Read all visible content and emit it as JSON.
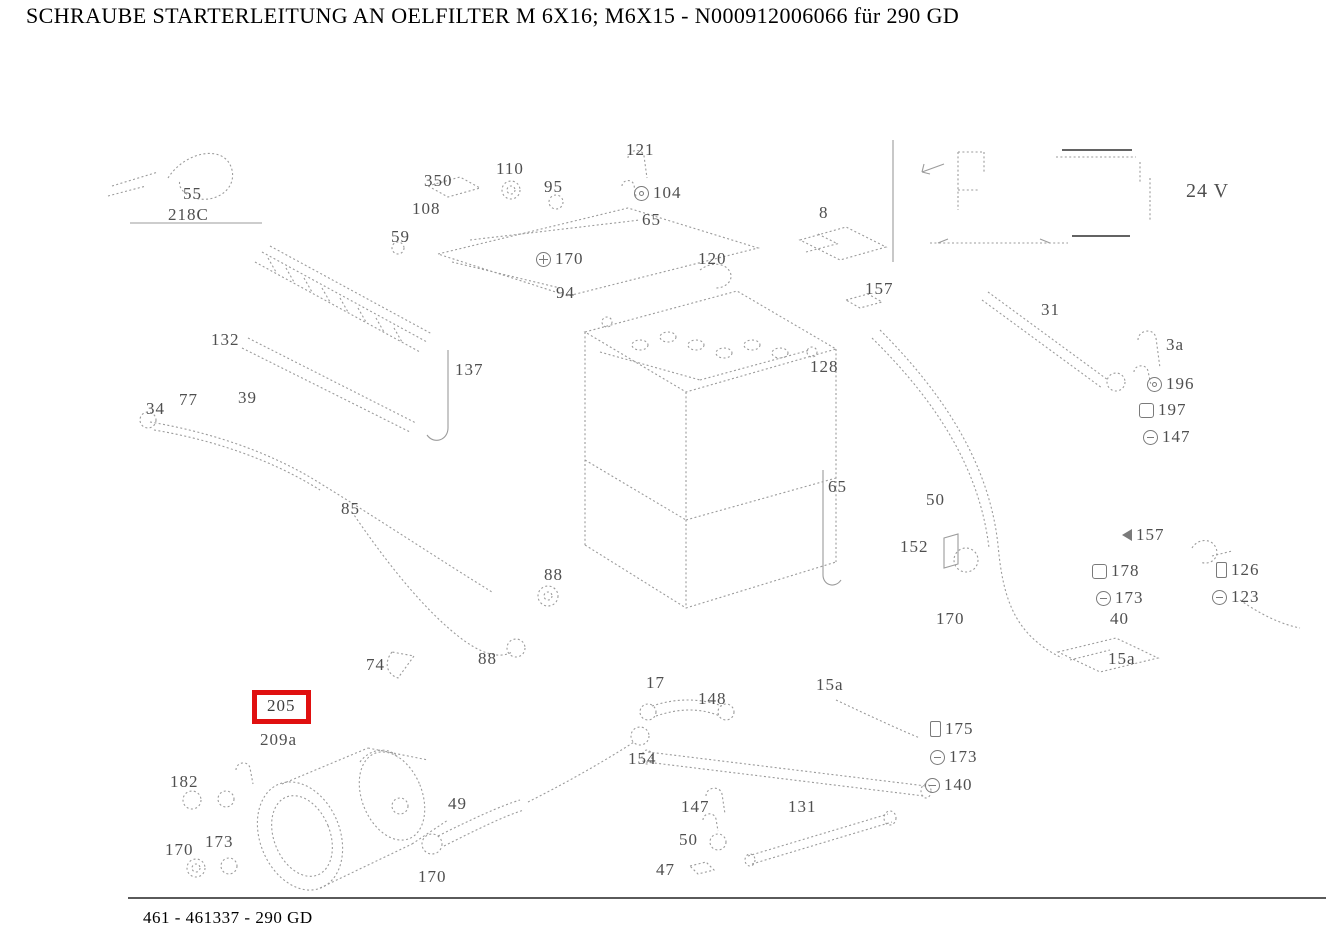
{
  "header": {
    "title": "SCHRAUBE STARTERLEITUNG AN OELFILTER M 6X16; M6X15 - N000912006066 für 290 GD"
  },
  "footer": {
    "reference": "461 - 461337 - 290 GD"
  },
  "diagram": {
    "highlighted_part": "205",
    "highlight_color": "#e01010",
    "line_color": "#9b9b9b",
    "voltage_note": "24 V",
    "labels": [
      {
        "text": "55",
        "x": 183,
        "y": 185
      },
      {
        "text": "218C",
        "x": 168,
        "y": 206
      },
      {
        "text": "350",
        "x": 424,
        "y": 172
      },
      {
        "text": "108",
        "x": 412,
        "y": 200
      },
      {
        "text": "110",
        "x": 496,
        "y": 160
      },
      {
        "text": "95",
        "x": 544,
        "y": 178
      },
      {
        "text": "121",
        "x": 626,
        "y": 141
      },
      {
        "text": "104",
        "x": 634,
        "y": 184,
        "icon": "washer"
      },
      {
        "text": "59",
        "x": 391,
        "y": 228
      },
      {
        "text": "170",
        "x": 536,
        "y": 250,
        "icon": "ground"
      },
      {
        "text": "120",
        "x": 698,
        "y": 250
      },
      {
        "text": "8",
        "x": 819,
        "y": 204
      },
      {
        "text": "157",
        "x": 865,
        "y": 280
      },
      {
        "text": "24 V",
        "x": 1186,
        "y": 180,
        "size": 20
      },
      {
        "text": "94",
        "x": 556,
        "y": 284
      },
      {
        "text": "65",
        "x": 642,
        "y": 211
      },
      {
        "text": "128",
        "x": 810,
        "y": 358
      },
      {
        "text": "31",
        "x": 1041,
        "y": 301
      },
      {
        "text": "3a",
        "x": 1166,
        "y": 336
      },
      {
        "text": "196",
        "x": 1147,
        "y": 375,
        "icon": "washer"
      },
      {
        "text": "197",
        "x": 1139,
        "y": 401,
        "icon": "nut"
      },
      {
        "text": "147",
        "x": 1143,
        "y": 428,
        "icon": "washer2"
      },
      {
        "text": "137",
        "x": 455,
        "y": 361
      },
      {
        "text": "132",
        "x": 211,
        "y": 331
      },
      {
        "text": "77",
        "x": 179,
        "y": 391
      },
      {
        "text": "39",
        "x": 238,
        "y": 389
      },
      {
        "text": "34",
        "x": 146,
        "y": 400
      },
      {
        "text": "85",
        "x": 341,
        "y": 500
      },
      {
        "text": "88",
        "x": 544,
        "y": 566
      },
      {
        "text": "88",
        "x": 478,
        "y": 650
      },
      {
        "text": "74",
        "x": 366,
        "y": 656
      },
      {
        "text": "65",
        "x": 828,
        "y": 478
      },
      {
        "text": "50",
        "x": 926,
        "y": 491
      },
      {
        "text": "152",
        "x": 900,
        "y": 538
      },
      {
        "text": "170",
        "x": 936,
        "y": 610
      },
      {
        "text": "157",
        "x": 1122,
        "y": 526,
        "icon": "arrow-left"
      },
      {
        "text": "178",
        "x": 1092,
        "y": 562,
        "icon": "nut"
      },
      {
        "text": "173",
        "x": 1096,
        "y": 589,
        "icon": "washer2"
      },
      {
        "text": "40",
        "x": 1110,
        "y": 610
      },
      {
        "text": "126",
        "x": 1216,
        "y": 561,
        "icon": "bolt"
      },
      {
        "text": "123",
        "x": 1212,
        "y": 588,
        "icon": "washer2"
      },
      {
        "text": "15a",
        "x": 1108,
        "y": 650
      },
      {
        "text": "15a",
        "x": 816,
        "y": 676
      },
      {
        "text": "17",
        "x": 646,
        "y": 674
      },
      {
        "text": "148",
        "x": 698,
        "y": 690
      },
      {
        "text": "154",
        "x": 628,
        "y": 750
      },
      {
        "text": "175",
        "x": 930,
        "y": 720,
        "icon": "bolt"
      },
      {
        "text": "173",
        "x": 930,
        "y": 748,
        "icon": "washer2"
      },
      {
        "text": "140",
        "x": 925,
        "y": 776,
        "icon": "washer2"
      },
      {
        "text": "131",
        "x": 788,
        "y": 798
      },
      {
        "text": "147",
        "x": 681,
        "y": 798
      },
      {
        "text": "50",
        "x": 679,
        "y": 831
      },
      {
        "text": "47",
        "x": 656,
        "y": 861
      },
      {
        "text": "49",
        "x": 448,
        "y": 795
      },
      {
        "text": "170",
        "x": 418,
        "y": 868
      },
      {
        "text": "205",
        "x": 252,
        "y": 690,
        "highlighted": true
      },
      {
        "text": "209a",
        "x": 260,
        "y": 731
      },
      {
        "text": "182",
        "x": 170,
        "y": 773
      },
      {
        "text": "170",
        "x": 165,
        "y": 841
      },
      {
        "text": "173",
        "x": 205,
        "y": 833
      }
    ]
  }
}
